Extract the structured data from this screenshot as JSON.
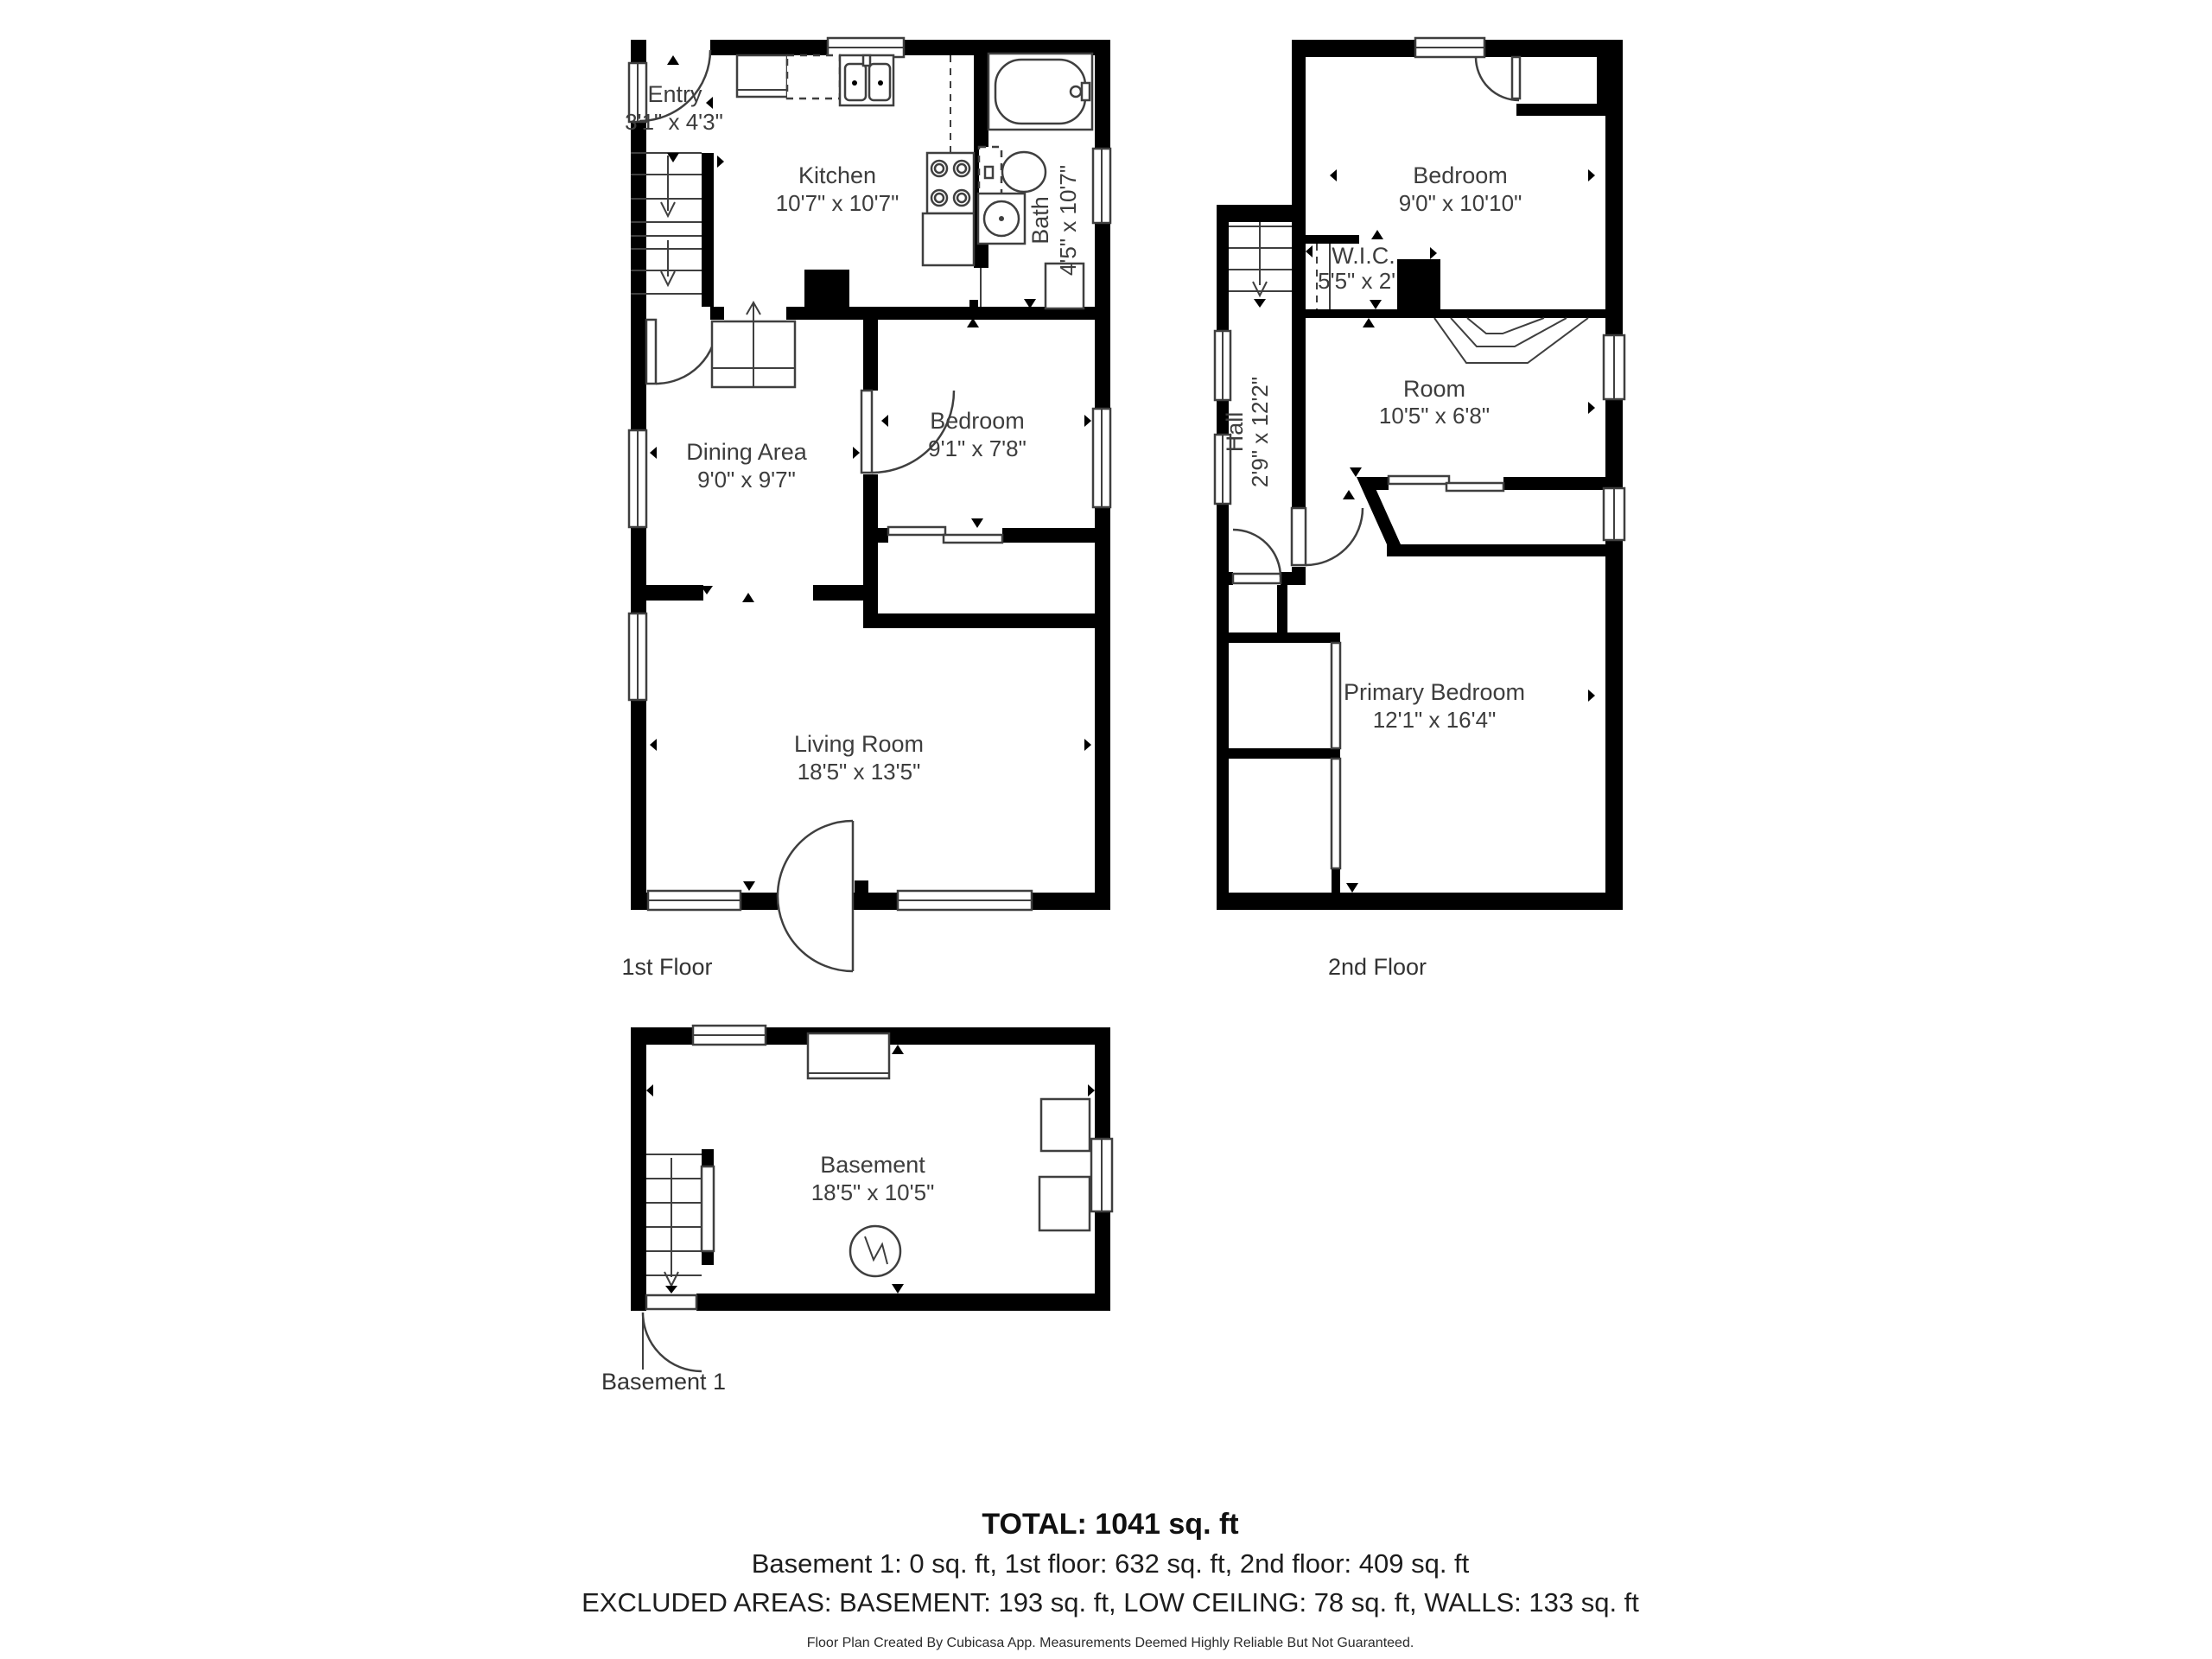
{
  "floors": {
    "first": {
      "label": "1st Floor",
      "rooms": {
        "entry": {
          "name": "Entry",
          "dims": "3'1\" x 4'3\""
        },
        "kitchen": {
          "name": "Kitchen",
          "dims": "10'7\" x 10'7\""
        },
        "bath": {
          "name": "Bath",
          "dims": "4'5\" x 10'7\""
        },
        "dining": {
          "name": "Dining Area",
          "dims": "9'0\" x 9'7\""
        },
        "bedroom": {
          "name": "Bedroom",
          "dims": "9'1\" x 7'8\""
        },
        "living": {
          "name": "Living Room",
          "dims": "18'5\" x 13'5\""
        }
      }
    },
    "second": {
      "label": "2nd Floor",
      "rooms": {
        "bedroom": {
          "name": "Bedroom",
          "dims": "9'0\" x 10'10\""
        },
        "wic": {
          "name": "W.I.C.",
          "dims": "5'5\" x 2'1\""
        },
        "hall": {
          "name": "Hall",
          "dims": "2'9\" x 12'2\""
        },
        "room": {
          "name": "Room",
          "dims": "10'5\" x 6'8\""
        },
        "primary": {
          "name": "Primary Bedroom",
          "dims": "12'1\" x 16'4\""
        }
      }
    },
    "basement": {
      "label": "Basement 1",
      "rooms": {
        "basement": {
          "name": "Basement",
          "dims": "18'5\" x 10'5\""
        }
      }
    }
  },
  "summary": {
    "total": "TOTAL: 1041 sq. ft",
    "breakdown": "Basement 1: 0 sq. ft, 1st floor: 632 sq. ft, 2nd floor: 409 sq. ft",
    "excluded": "EXCLUDED AREAS: BASEMENT: 193 sq. ft, LOW CEILING: 78 sq. ft, WALLS: 133 sq. ft",
    "disclaimer": "Floor Plan Created By Cubicasa App. Measurements Deemed Highly Reliable But Not Guaranteed."
  },
  "colors": {
    "wall": "#000000",
    "line": "#3f3f3f",
    "text": "#3d3d3d"
  }
}
